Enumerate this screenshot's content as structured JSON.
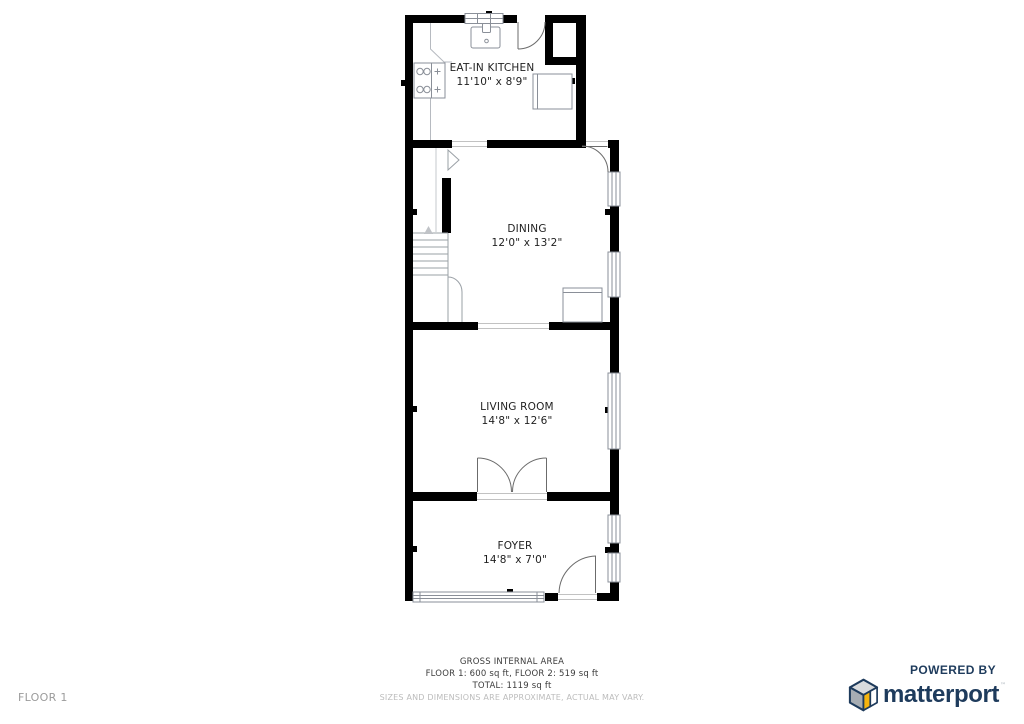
{
  "plan": {
    "rooms": [
      {
        "name": "EAT-IN KITCHEN",
        "dims": "11'10\" x 8'9\""
      },
      {
        "name": "DINING",
        "dims": "12'0\" x 13'2\""
      },
      {
        "name": "LIVING ROOM",
        "dims": "14'8\" x 12'6\""
      },
      {
        "name": "FOYER",
        "dims": "14'8\" x 7'0\""
      }
    ]
  },
  "footer": {
    "gross_label": "GROSS INTERNAL AREA",
    "floors_line": "FLOOR 1: 600 sq ft, FLOOR 2: 519 sq ft",
    "total_line": "TOTAL: 1119 sq ft",
    "disclaimer": "SIZES AND DIMENSIONS ARE APPROXIMATE, ACTUAL MAY VARY."
  },
  "floor_label": "FLOOR 1",
  "branding": {
    "powered_by": "POWERED BY",
    "brand_name": "matterport",
    "trademark": "™"
  },
  "colors": {
    "wall": "#000000",
    "fixture_line": "#8a8f98",
    "brand_navy": "#1e3b5c",
    "brand_yellow": "#f6b40e",
    "muted_text": "#bcbcbc"
  },
  "icons": {
    "brand_cube": "matterport-cube-icon",
    "stairs_direction": "up-arrow-icon"
  }
}
